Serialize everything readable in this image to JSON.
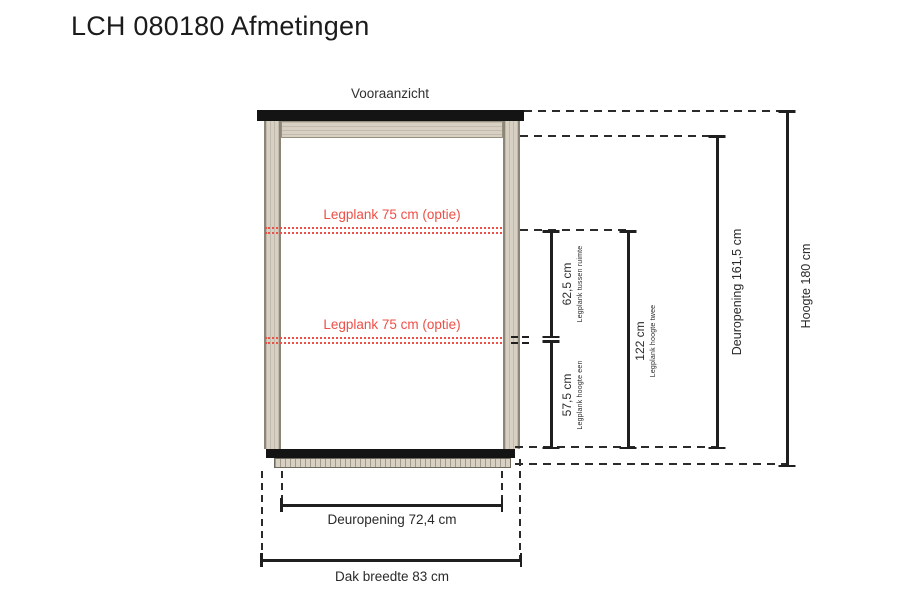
{
  "page": {
    "title": "LCH 080180 Afmetingen",
    "view_label": "Vooraanzicht"
  },
  "colors": {
    "accent_red": "#ee4f46",
    "line": "#1f1f1f",
    "wood": "#d8d1c3",
    "wood_edge": "#8b8678",
    "frame_dark": "#141414"
  },
  "shelves": {
    "shelf1_label": "Legplank 75 cm (optie)",
    "shelf2_label": "Legplank 75 cm (optie)"
  },
  "dims": {
    "tussenruimte": {
      "value": "62,5 cm",
      "caption": "Legplank tussen ruimte"
    },
    "hoogte_een": {
      "value": "57,5 cm",
      "caption": "Legplank hoogte een"
    },
    "hoogte_twee": {
      "value": "122 cm",
      "caption": "Legplank hoogte twee"
    },
    "deuropening_v": {
      "value": "Deuropening 161,5 cm"
    },
    "hoogte_totaal": {
      "value": "Hoogte 180 cm"
    },
    "deuropening_h": {
      "value": "Deuropening 72,4 cm"
    },
    "dak_breedte": {
      "value": "Dak breedte 83 cm"
    }
  }
}
